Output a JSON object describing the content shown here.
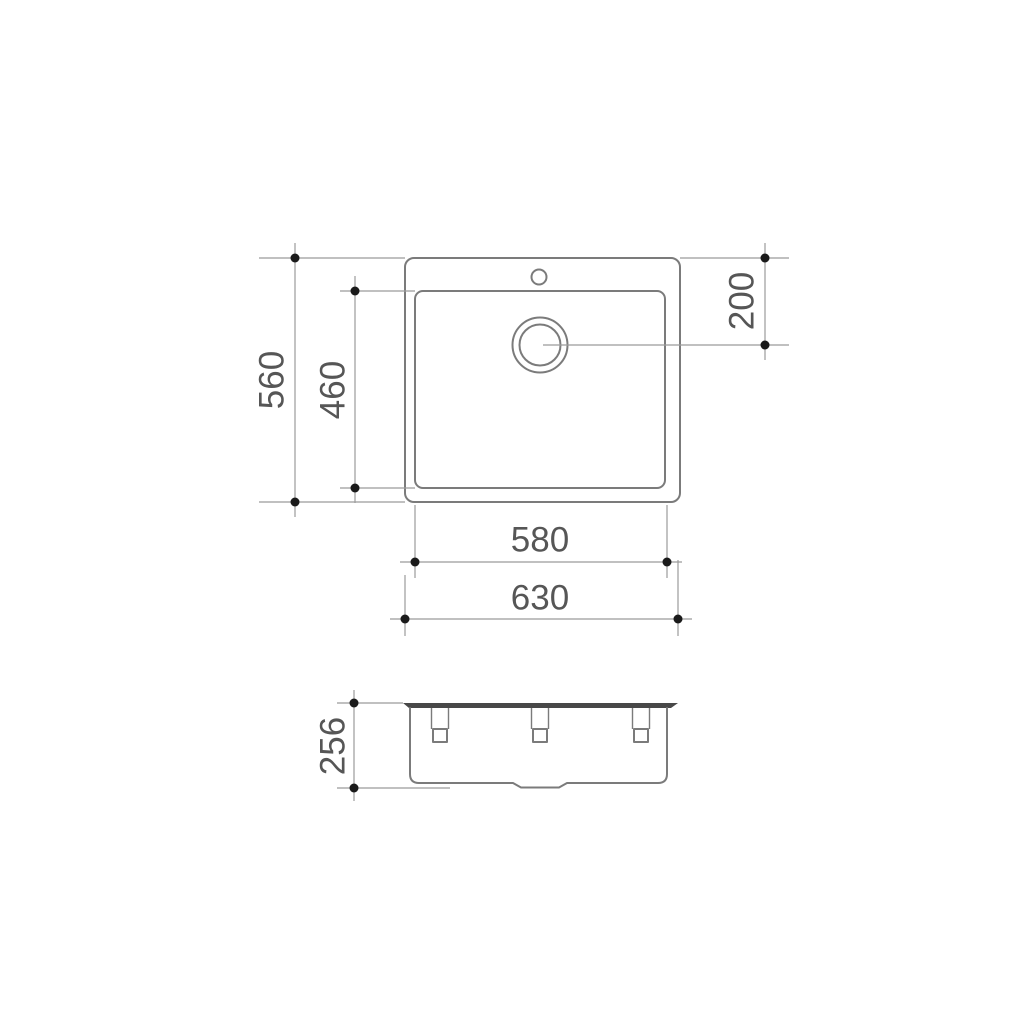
{
  "diagram": {
    "colors": {
      "background": "#ffffff",
      "outline": "#7b7b7b",
      "dimension_line": "#9b9b9b",
      "dimension_dot": "#1a1a1a",
      "label_text": "#565656",
      "rim_fill": "#484848"
    },
    "top_view": {
      "dimensions": {
        "overall_depth": "560",
        "bowl_depth": "460",
        "drain_center_offset": "200",
        "bowl_width": "580",
        "overall_width": "630"
      }
    },
    "side_view": {
      "dimensions": {
        "overall_height": "256"
      }
    }
  }
}
